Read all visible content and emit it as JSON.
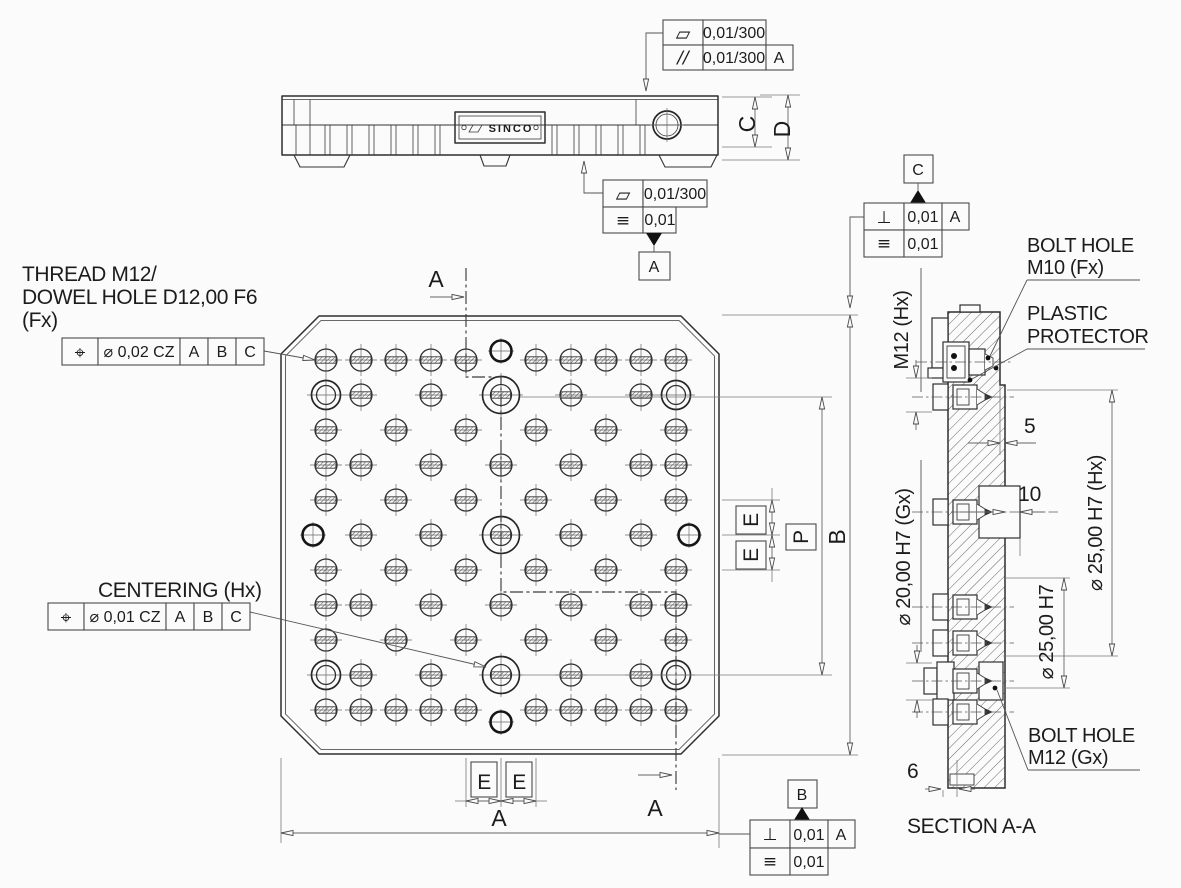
{
  "side_view": {
    "nameplate": "SINCO",
    "dims": {
      "c": "C",
      "d": "D"
    },
    "fcf_top": {
      "row1_sym": "▱",
      "row1_val": "0,01/300",
      "row2_sym": "//",
      "row2_val": "0,01/300",
      "row2_datum": "A"
    },
    "fcf_bottom": {
      "row1_sym": "▱",
      "row1_val": "0,01/300",
      "row2_sym": "≡",
      "row2_val": "0,01",
      "datum": "A"
    }
  },
  "plan_view": {
    "thread_callout": {
      "line1": "THREAD M12/",
      "line2": "DOWEL HOLE D12,00 F6",
      "line3": "(Fx)"
    },
    "thread_fcf": {
      "sym": "⌖",
      "tol": "⌀ 0,02 CZ",
      "datum1": "A",
      "datum2": "B",
      "datum3": "C"
    },
    "centering_callout": "CENTERING (Hx)",
    "centering_fcf": {
      "sym": "⌖",
      "tol": "⌀ 0,01 CZ",
      "datum1": "A",
      "datum2": "B",
      "datum3": "C"
    },
    "cut_label_top": "A",
    "cut_label_bottom": "A",
    "dim_e1": "E",
    "dim_e2": "E",
    "dim_p": "P",
    "dim_b": "B",
    "dim_e3": "E",
    "dim_e4": "E",
    "dim_a": "A",
    "grid": {
      "col_x": [
        326,
        361,
        396,
        431,
        466,
        501,
        536,
        571,
        606,
        641,
        676
      ],
      "row_y": [
        360,
        395,
        430,
        465,
        500,
        535,
        570,
        605,
        640,
        675,
        710
      ],
      "cells": [
        "ttttt.ttttt",
        "dt.t.C.t.td",
        "t.t.t.t.t.t",
        "tt.t.t.t.tt",
        "t.t.t.t.t.t",
        ".t.t.C.t.t.",
        "t.t.t.t.t.t",
        "tt.t.t.t.tt",
        "t.t.t.t.t.t",
        "dt.t.C.t.td",
        "ttttt.ttttt"
      ],
      "extra_bold": [
        {
          "x": 501,
          "y": 351
        },
        {
          "x": 501,
          "y": 722
        },
        {
          "x": 313,
          "y": 535
        },
        {
          "x": 689,
          "y": 535
        }
      ]
    }
  },
  "right_fcf_top": {
    "datum_label": "C",
    "row1_sym": "⊥",
    "row1_val": "0,01",
    "row1_datum": "A",
    "row2_sym": "≡",
    "row2_val": "0,01"
  },
  "right_fcf_bottom": {
    "datum_label": "B",
    "row1_sym": "⊥",
    "row1_val": "0,01",
    "row1_datum": "A",
    "row2_sym": "≡",
    "row2_val": "0,01"
  },
  "section_view": {
    "title": "SECTION A-A",
    "label_m12": "M12 (Hx)",
    "label_d20": "⌀ 20,00 H7 (Gx)",
    "label_d25hx": "⌀ 25,00 H7 (Hx)",
    "label_d25": "⌀ 25,00 H7",
    "label_bolt_m10_1": "BOLT HOLE",
    "label_bolt_m10_2": "M10 (Fx)",
    "label_plastic_1": "PLASTIC",
    "label_plastic_2": "PROTECTOR",
    "label_bolt_m12_1": "BOLT HOLE",
    "label_bolt_m12_2": "M12 (Gx)",
    "dim_5": "5",
    "dim_10": "10",
    "dim_6": "6"
  }
}
